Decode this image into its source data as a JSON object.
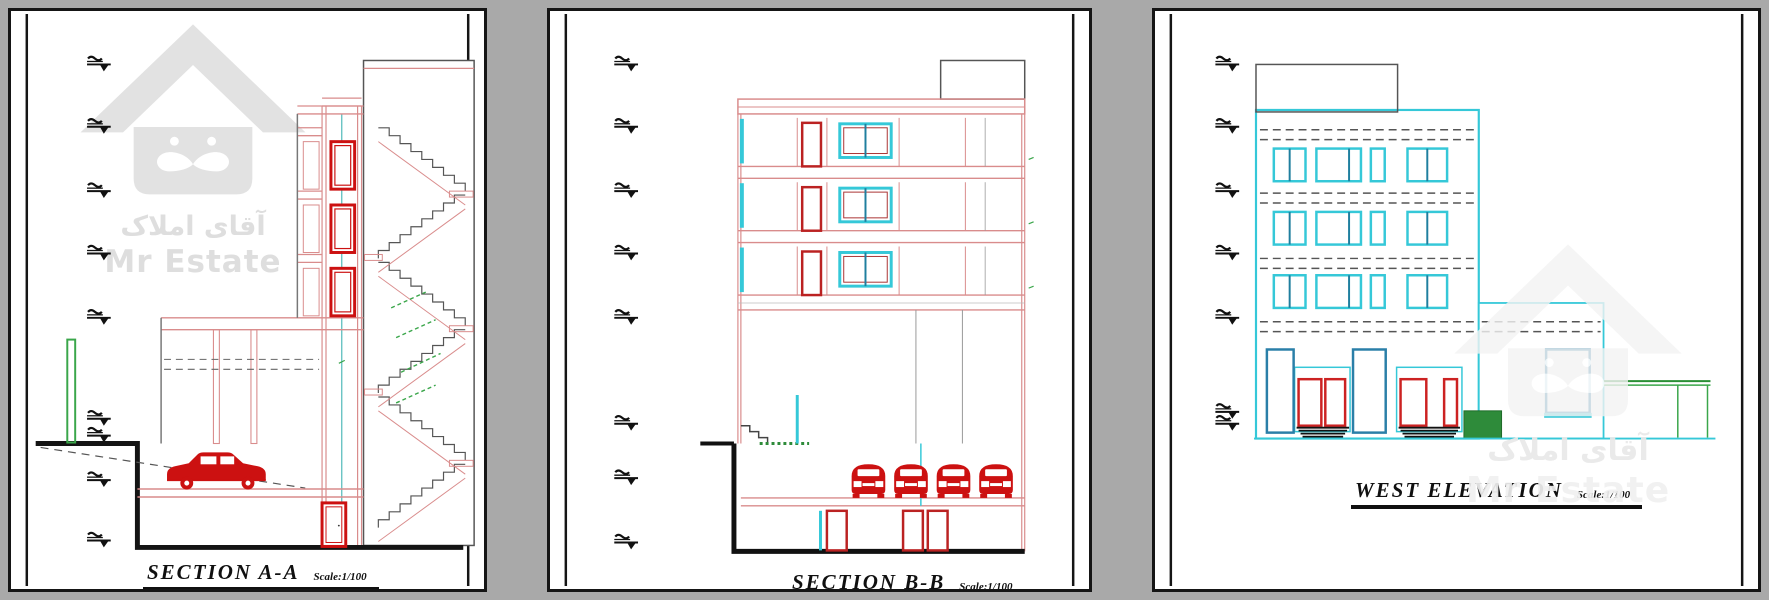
{
  "page": {
    "background": "#a9a9a9",
    "sheet_background": "#ffffff"
  },
  "watermark": {
    "brand_en": "Mr Estate",
    "brand_fa": "آقای املاک",
    "logo": "house-mustache-logo"
  },
  "panels": [
    {
      "id": "section-a-a",
      "title": "SECTION A-A",
      "scale_label": "Scale:1/100",
      "features": [
        "level-markers",
        "elevator-shaft",
        "elevator-doors",
        "staircase",
        "ramp",
        "car",
        "basement-door",
        "green-post"
      ]
    },
    {
      "id": "section-b-b",
      "title": "SECTION B-B",
      "scale_label": "Scale:1/100",
      "features": [
        "level-markers",
        "penthouse",
        "floor-doors",
        "floor-windows",
        "entry-steps",
        "parked-cars",
        "basement-doors"
      ]
    },
    {
      "id": "west-elevation",
      "title": "WEST ELEVATION",
      "scale_label": "Scale:1/100",
      "features": [
        "level-markers",
        "penthouse",
        "window-grid",
        "brick-bands",
        "entrance-doors",
        "stoop-steps",
        "planter",
        "side-wing",
        "garden-fence"
      ]
    }
  ],
  "colors": {
    "wall_pink": "#d98c8c",
    "accent_red": "#cc1111",
    "door_red": "#bb2222",
    "window_cyan": "#35c8d8",
    "window_teal": "#2a7fa8",
    "landscape_green": "#3aa64a",
    "planter_green_fill": "#2e8b3a",
    "structure_dark": "#1a1a1a"
  }
}
